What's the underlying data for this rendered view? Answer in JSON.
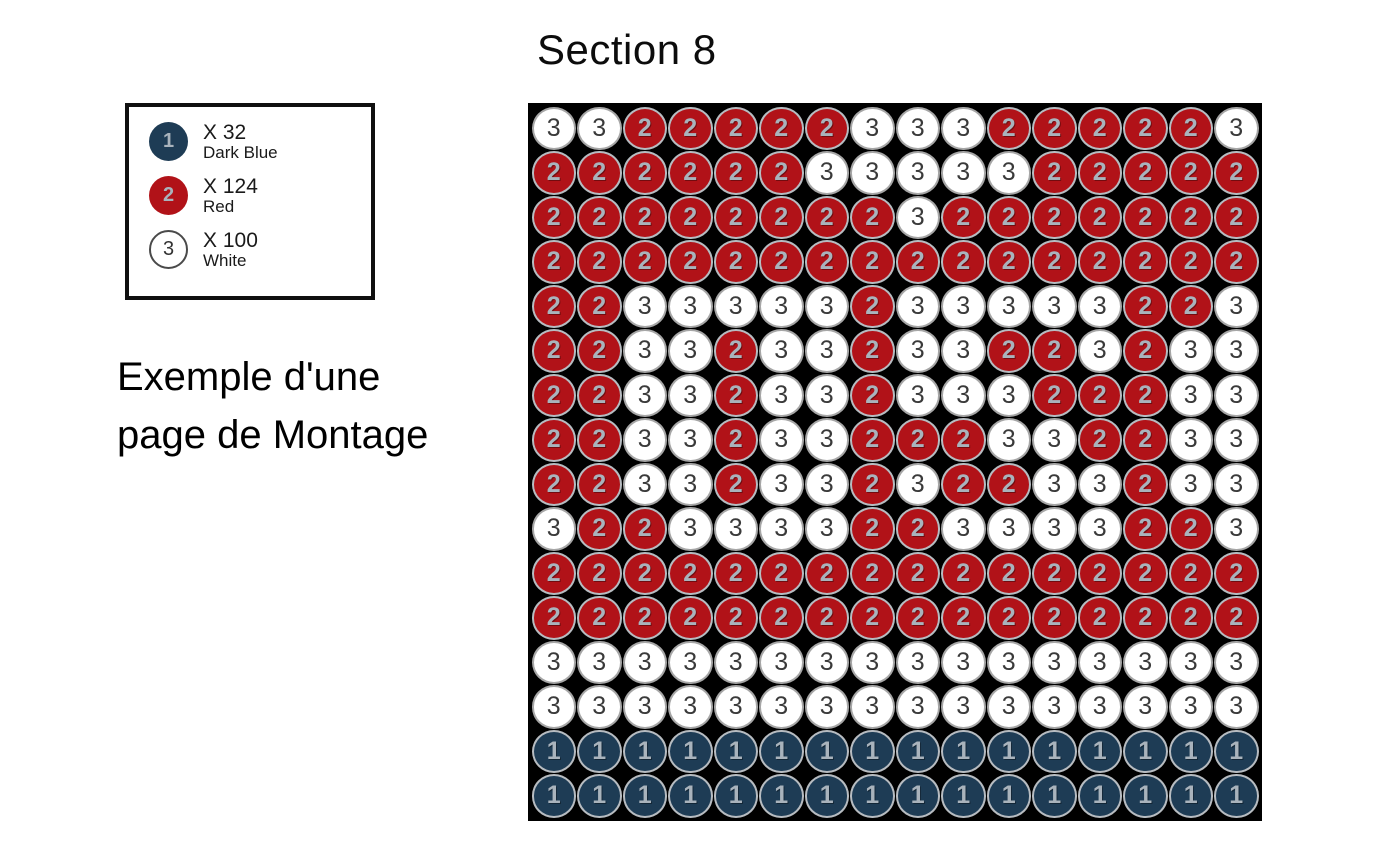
{
  "title": "Section 8",
  "caption": {
    "line1": "Exemple d'une",
    "line2": "page de Montage"
  },
  "legend": {
    "items": [
      {
        "number": "1",
        "count_label": "X 32",
        "color_name": "Dark Blue",
        "fill": "#1e3c55",
        "ring": "#1e3c55",
        "text_color": "#a9b3bc"
      },
      {
        "number": "2",
        "count_label": "X 124",
        "color_name": "Red",
        "fill": "#b11218",
        "ring": "#b11218",
        "text_color": "#a9b3bc"
      },
      {
        "number": "3",
        "count_label": "X 100",
        "color_name": "White",
        "fill": "#ffffff",
        "ring": "#4a4a4a",
        "text_color": "#333333"
      }
    ]
  },
  "grid": {
    "rows": 16,
    "cols": 16,
    "background": "#000000",
    "cells": [
      "3322222333222223",
      "2222223333322222",
      "2222222232222222",
      "2222222222222222",
      "2233333233333223",
      "2233233233223233",
      "2233233233322233",
      "2233233222332233",
      "2233233232233233",
      "3223333223333223",
      "2222222222222222",
      "2222222222222222",
      "3333333333333333",
      "3333333333333333",
      "1111111111111111",
      "1111111111111111"
    ],
    "bead_styles": {
      "1": {
        "fill": "#1e3c55",
        "text": "#a9b3bc",
        "ring": "#b7bcc1"
      },
      "2": {
        "fill": "#b11218",
        "text": "#a9b3bc",
        "ring": "#b7bcc1"
      },
      "3": {
        "fill": "#ffffff",
        "text": "#3a3a3a",
        "ring": "#a6a6a6"
      }
    }
  }
}
